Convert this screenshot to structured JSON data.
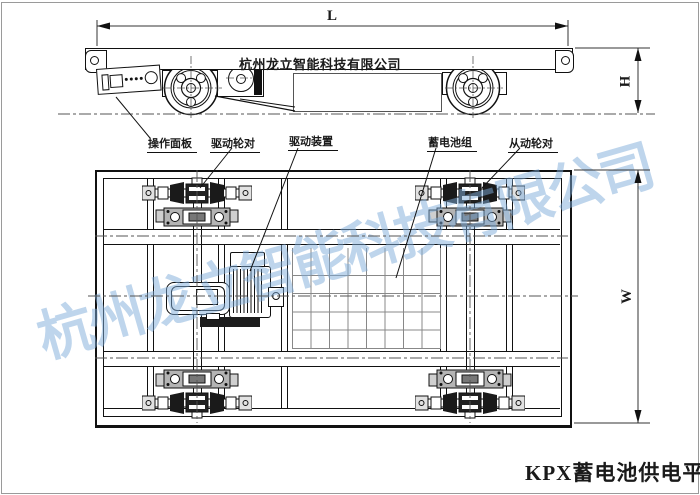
{
  "drawing": {
    "caption": "KPX蓄电池供电平车",
    "deck_company_text": "杭州龙立智能科技有限公司",
    "watermark_text": "杭州龙立智能科技有限公司",
    "dimensions": {
      "length": "L",
      "height": "H",
      "width": "W"
    },
    "part_labels": {
      "operation_panel": "操作面板",
      "drive_wheelset": "驱动轮对",
      "drive_unit": "驱动装置",
      "battery_pack": "蓄电池组",
      "driven_wheelset": "从动轮对"
    },
    "colors": {
      "line": "#1a1a1a",
      "bracket_gray": "#b4b4b4",
      "watermark_blue": "#7dacda",
      "grid_line": "#888888",
      "page_border": "#9a9a9a"
    }
  }
}
